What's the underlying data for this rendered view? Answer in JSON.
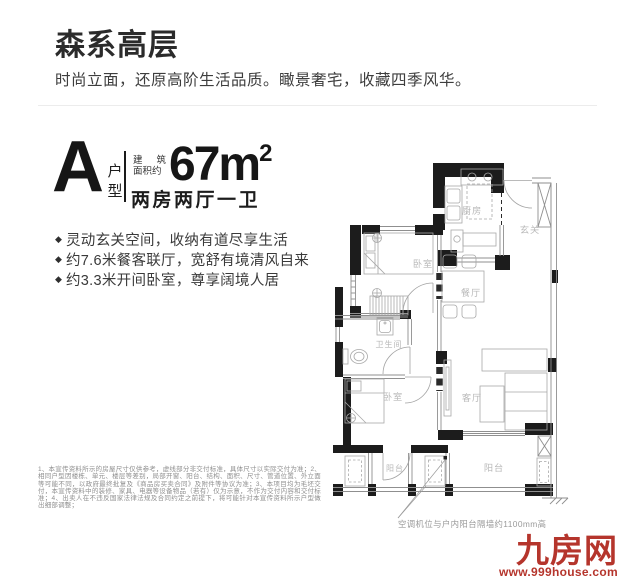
{
  "header": {
    "title": "森系高层",
    "subtitle": "时尚立面，还原高阶生活品质。瞰景奢宅，收藏四季风华。"
  },
  "unit": {
    "letter": "A",
    "letter_suffix_1": "户",
    "letter_suffix_2": "型",
    "area_prefix_r1c1": "建",
    "area_prefix_r1c2": "筑",
    "area_prefix_r2": "面积约",
    "area_value": "67m",
    "area_sup": "2",
    "layout": "两房两厅一卫"
  },
  "features": {
    "bullet": "◆",
    "items": [
      "灵动玄关空间，收纳有道尽享生活",
      "约7.6米餐客联厅，宽舒有境清风自来",
      "约3.3米开间卧室，尊享阔境人居"
    ]
  },
  "floorplan": {
    "rooms": {
      "kitchen": "厨房",
      "entry": "玄关",
      "bedroom1": "卧室",
      "dining": "餐厅",
      "bathroom": "卫生间",
      "bedroom2": "卧室",
      "living": "客厅",
      "balcony_small": "阳台",
      "balcony_large": "阳台"
    },
    "note": "空调机位与户内阳台隔墙约1100mm高"
  },
  "disclaimer": "1、本宣传资料所示的房屋尺寸仅供参考，虚线部分非交付标准，具体尺寸以实际交付为准；2、相同户型因楼栋、单元、楼层等差别，局部开窗、阳台、结构、面积、尺寸、管道位置、外立面等可能不同，以政府最终批复及《商品房买卖合同》及附件等协议为准；3、本项目均为毛坯交付，本宣传资料中的装修、家具、电器等设备物品（若有）仅为示意，不作为交付内容和交付标准；4、出卖人在不违反国家法律法规及合同约定之前提下，将可能针对本宣传资料所示户型做出细部调整；",
  "footer": {
    "logo": "九房网",
    "url": "www.999house.com",
    "brand_color": "#b5352c"
  }
}
